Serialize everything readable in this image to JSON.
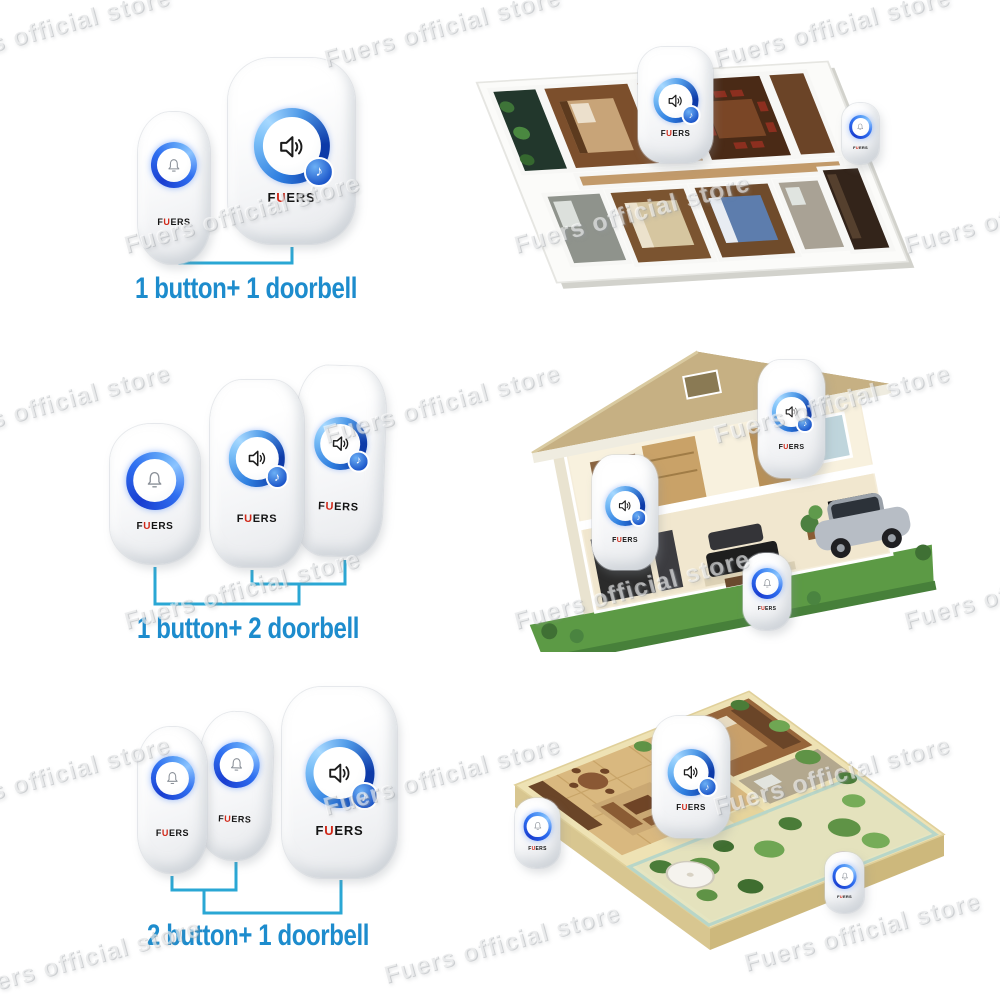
{
  "watermark": {
    "text": "Fuers official store"
  },
  "brand": {
    "f": "F",
    "u": "U",
    "ers": "ERS",
    "full": "FUERS",
    "logo_red": "#d02818"
  },
  "icons": {
    "bell": "bell-outline-icon",
    "speaker": "speaker-sound-waves-icon",
    "music_note": "♪"
  },
  "colors": {
    "label_blue": "#1d8ccd",
    "bracket_cyan": "#2aa7d4",
    "led_ring_blue": "#2f7fe0",
    "device_white": "#ffffff",
    "logo_red": "#d02818"
  },
  "rows": [
    {
      "label": "1 button+ 1 doorbell",
      "buttons": 1,
      "doorbells": 1,
      "scene": "apartment floor plan"
    },
    {
      "label": "1 button+ 2 doorbell",
      "buttons": 1,
      "doorbells": 2,
      "scene": "two-story house cutaway with car"
    },
    {
      "label": "2 button+ 1 doorbell",
      "buttons": 2,
      "doorbells": 1,
      "scene": "penthouse terrace floor plan with garden"
    }
  ]
}
